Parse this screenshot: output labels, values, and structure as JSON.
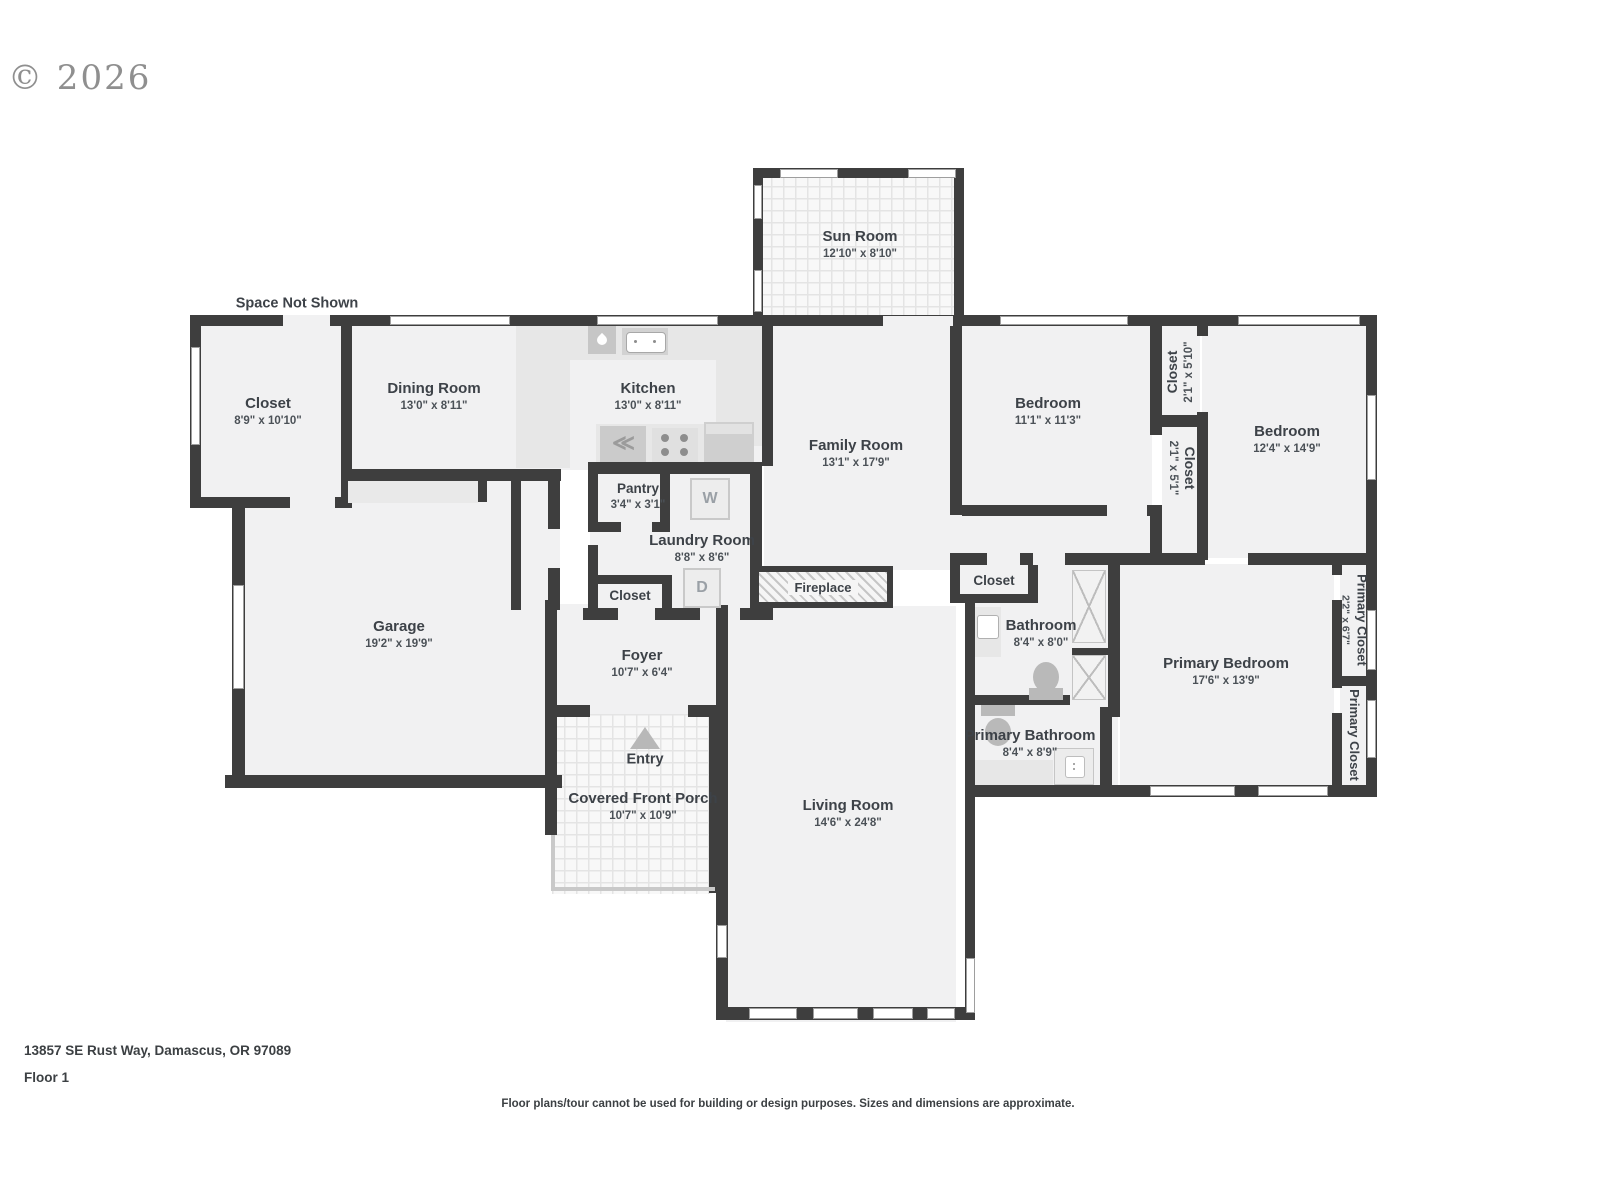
{
  "copyright": "© 2026",
  "annotations": {
    "space_not_shown": "Space Not Shown",
    "entry": "Entry"
  },
  "rooms": {
    "sun_room": {
      "name": "Sun Room",
      "dims": "12'10\" x 8'10\""
    },
    "closet_left": {
      "name": "Closet",
      "dims": "8'9\" x 10'10\""
    },
    "dining_room": {
      "name": "Dining Room",
      "dims": "13'0\" x 8'11\""
    },
    "kitchen": {
      "name": "Kitchen",
      "dims": "13'0\" x 8'11\""
    },
    "family_room": {
      "name": "Family Room",
      "dims": "13'1\" x 17'9\""
    },
    "bedroom_1": {
      "name": "Bedroom",
      "dims": "11'1\" x 11'3\""
    },
    "closet_bed_top": {
      "name": "Closet",
      "dims": "2'1\" x 5'10\""
    },
    "closet_bed_bot": {
      "name": "Closet",
      "dims": "2'1\" x 5'1\""
    },
    "bedroom_2": {
      "name": "Bedroom",
      "dims": "12'4\" x 14'9\""
    },
    "pantry": {
      "name": "Pantry",
      "dims": "3'4\" x 3'1\""
    },
    "laundry_room": {
      "name": "Laundry Room",
      "dims": "8'8\" x 8'6\""
    },
    "closet_laundry": {
      "name": "Closet"
    },
    "fireplace": {
      "name": "Fireplace"
    },
    "garage": {
      "name": "Garage",
      "dims": "19'2\" x 19'9\""
    },
    "foyer": {
      "name": "Foyer",
      "dims": "10'7\" x 6'4\""
    },
    "covered_porch": {
      "name": "Covered Front Porch",
      "dims": "10'7\" x 10'9\""
    },
    "living_room": {
      "name": "Living Room",
      "dims": "14'6\" x 24'8\""
    },
    "closet_hall": {
      "name": "Closet"
    },
    "bathroom": {
      "name": "Bathroom",
      "dims": "8'4\" x 8'0\""
    },
    "primary_bathroom": {
      "name": "Primary Bathroom",
      "dims": "8'4\" x 8'9\""
    },
    "primary_bedroom": {
      "name": "Primary Bedroom",
      "dims": "17'6\" x 13'9\""
    },
    "primary_closet_1": {
      "name": "Primary Closet",
      "dims": "2'2\" x 6'7\""
    },
    "primary_closet_2": {
      "name": "Primary Closet"
    }
  },
  "fixtures": {
    "washer": "W",
    "dryer": "D",
    "range_glyph": "≪"
  },
  "footer": {
    "address": "13857 SE Rust Way, Damascus, OR 97089",
    "floor": "Floor 1",
    "disclaimer": "Floor plans/tour cannot be used for building or design purposes. Sizes and dimensions are approximate."
  },
  "colors": {
    "wall": "#3e3e3e",
    "floor": "#f1f1f2",
    "text": "#3d4248"
  }
}
